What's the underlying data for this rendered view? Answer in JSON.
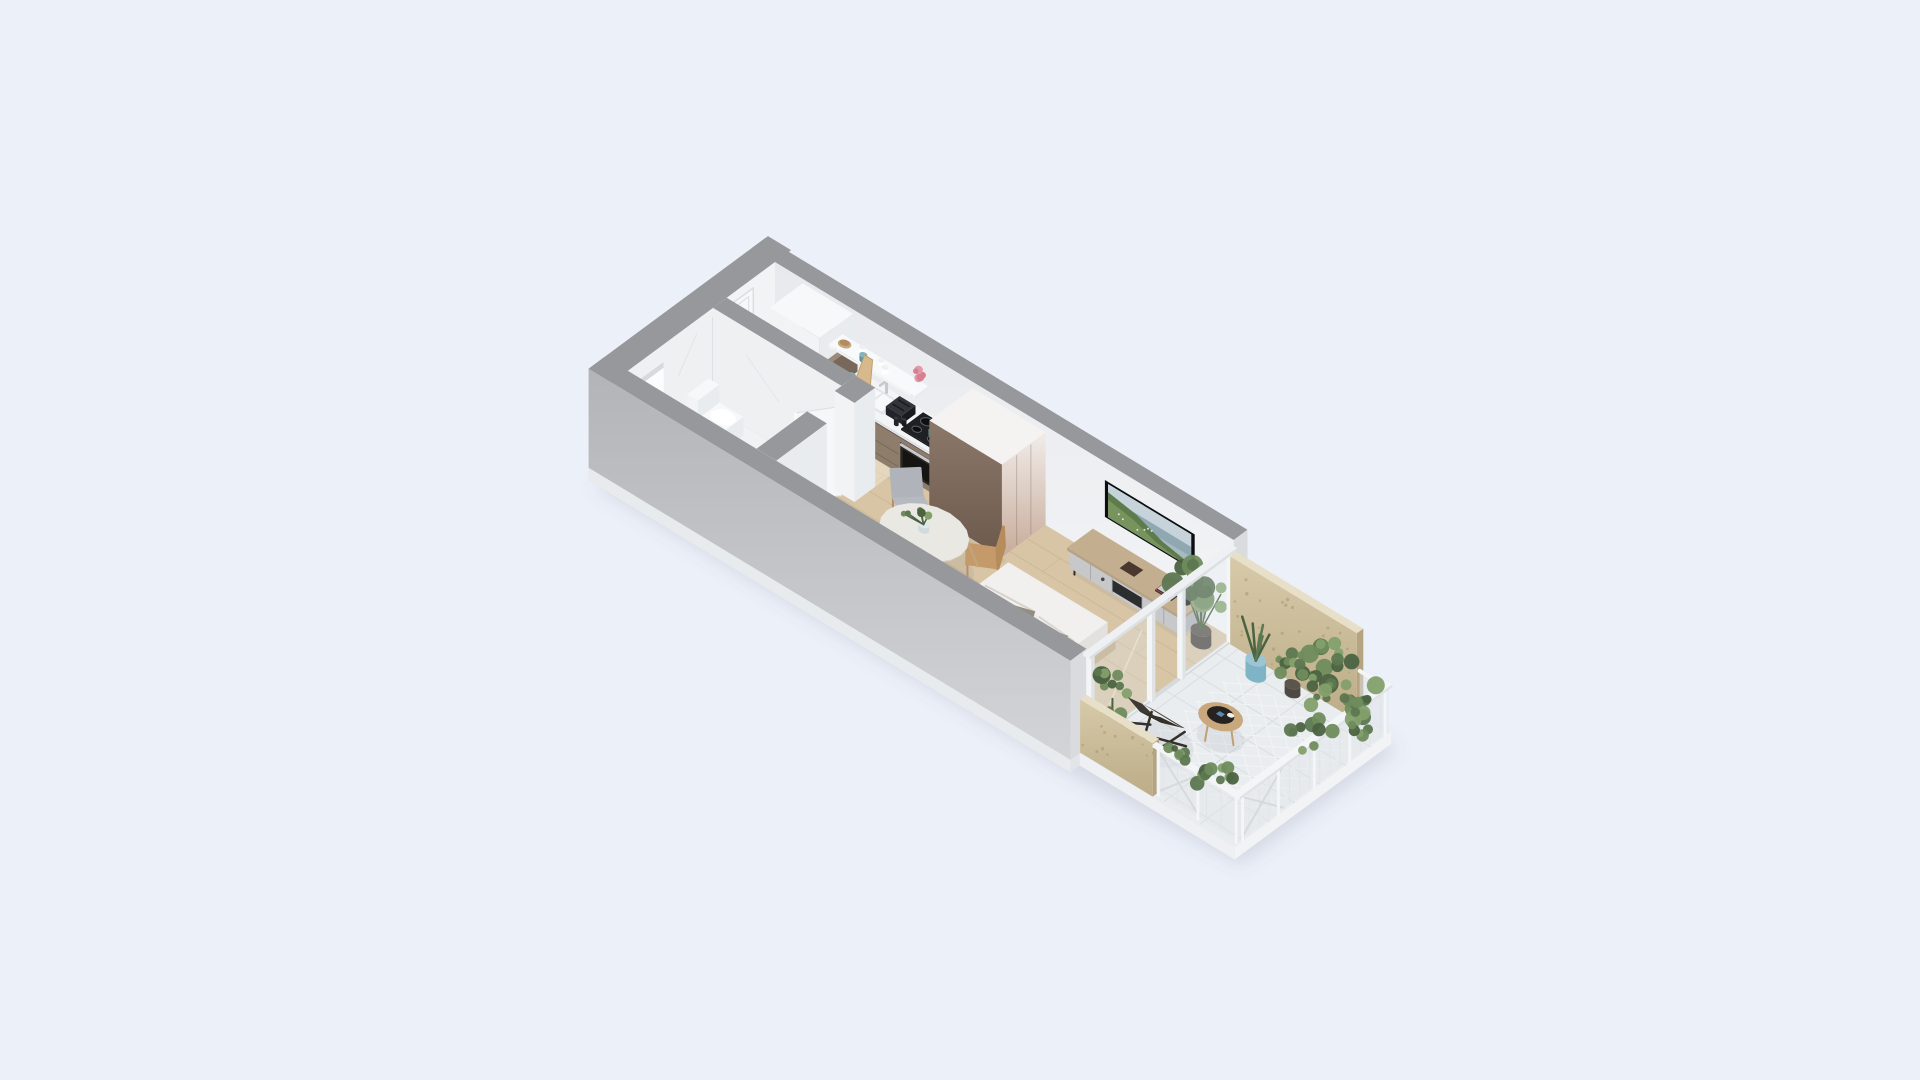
{
  "meta": {
    "description": "Isometric 3D render of a studio apartment floor plan with entry hall, kitchen, marble bathroom, living-bedroom area and a plant-filled balcony, on a pale blue background"
  },
  "rooms": [
    {
      "name": "entry-hall",
      "floor": "wood"
    },
    {
      "name": "bathroom",
      "floor": "marble"
    },
    {
      "name": "kitchen",
      "floor": "wood"
    },
    {
      "name": "living-bedroom",
      "floor": "wood"
    },
    {
      "name": "balcony",
      "floor": "white-tile"
    }
  ],
  "furniture": [
    "entry-door",
    "window-opening",
    "kitchen-tall-cabinet",
    "kitchen-wall-cabinet",
    "kitchen-counter",
    "kitchen-sink",
    "faucet",
    "cooktop",
    "oven",
    "toaster",
    "open-shelf",
    "cutting-board",
    "dishes",
    "flower-vase",
    "bathroom-door",
    "toilet",
    "vanity",
    "shower-tray",
    "wardrobe",
    "dining-table",
    "dining-chairs",
    "table-plant",
    "bench-sofa",
    "side-cube",
    "tv",
    "tv-console",
    "books",
    "speaker",
    "tray",
    "double-bed",
    "mattress",
    "blanket",
    "duvet",
    "pillows",
    "indoor-plant",
    "glass-sliding-door",
    "balcony-plywood-panels",
    "balcony-railing",
    "lounge-chair",
    "balcony-side-table",
    "potted-plants",
    "hanging-plants",
    "blue-pot"
  ],
  "palette": {
    "bg": "#ecf0f9",
    "shadow": "rgba(98,108,130,0.18)",
    "slab1": "#e8ebee",
    "slab2": "#eef0f3",
    "slab3": "#f1f3f5",
    "slabStep": "#e2e5e8",
    "wallTop": "#97989c",
    "extTop": "#b2b4b8",
    "extBot": "#d2d4d7",
    "cap": "#d9dbdf",
    "neTop": "#e7e9ed",
    "neBot": "#f3f4f6",
    "nwFace": "#f2f3f5",
    "marbleFace": "#eef0f2",
    "marbleFloor": "#f0f2f4",
    "vein": "#dde0e4",
    "wood": "#d8c5a6",
    "woodLine": "#c4ae8c",
    "entry": "rgba(240,230,208,0.55)",
    "tile": "#eaedef",
    "tileLine": "#d8dce0",
    "hatch": "#f3f5f6",
    "door": "#f6f7f9",
    "doorFrame": "#dcdee1",
    "handle": "#6f7276",
    "winLight": "#fbfcfe",
    "winShade": "#cfd3d8",
    "cabFace": "#8f7d6c",
    "cabSide": "#77685b",
    "cabDark": "#60554b",
    "colTop": "#9c8a79",
    "counter": "#f3f4f6",
    "counterEdge": "#e2e4e7",
    "shelf": "#f8f9fa",
    "shelfSide": "#e9ebee",
    "stove": "#1f2023",
    "stoveSide": "#121315",
    "burner": "#0e0f11",
    "ring": "#5d6065",
    "ovenFrame": "#2b2824",
    "ovenGlass": "#151413",
    "steel": "#c6c8cb",
    "toastT": "#33353a",
    "toastF": "#23242a",
    "toastS": "#191a1e",
    "board": "#d8b98c",
    "boardEdge": "#c0a070",
    "whiteT": "#f7f8fa",
    "whiteSE": "#e9ecef",
    "whiteSW": "#f1f3f5",
    "wardTop": "#f4f3f2",
    "wardFT": "#f1ece9",
    "wardFB": "#c7ab9a",
    "wardST": "#8b7869",
    "wardSB": "#6c594d",
    "wardSeam": "rgba(110,88,74,0.3)",
    "benchBase": "#e0dbd7",
    "benchSide": "#cfc9c5",
    "cushA": "#dccccc",
    "cushB": "#cfbdbd",
    "backA": "#e3d5d5",
    "backB": "#d6c6c6",
    "pill": "#efeae6",
    "darkT": "#554e47",
    "darkTse": "#413b35",
    "darkTsw": "#4b443e",
    "tableT": "#e9e8e3",
    "tableE": "#d1cfc8",
    "legW": "#c2a47c",
    "seatG": "#b6bac0",
    "seatG2": "#abafb5",
    "backG": "#b0b4ba",
    "woodCh": "#c59a6b",
    "woodChB": "#b78c5b",
    "chLeg": "#b3906a",
    "conSE": "#b0b2b5",
    "conSW": "#c7c8ca",
    "conTT": "#c3af90",
    "conTSE": "#a8957a",
    "conTSW": "#b6a286",
    "recess": "#2c2d2f",
    "conSeam": "#9c9ea2",
    "conHandle": "#46474a",
    "tvFrame": "#0d0e10",
    "tvSky": "#c6d3da",
    "tvSea": "#8fa8b2",
    "tvBase": "#a7bac2",
    "hillA": "#5e7b4c",
    "hillB": "#7a9661",
    "speck": "#e9ece7",
    "stand": "#222327",
    "bookA": "#a8403a",
    "bookB": "#30323a",
    "spk": "#191a1d",
    "spkT": "#2c2d31",
    "tray": "#4a382e",
    "bpT": "#d6c2a0",
    "bpSE": "#c2aa86",
    "bpSW": "#cdb694",
    "matT": "#ebeae8",
    "matSE": "#dbdad7",
    "matSW": "#cfcecb",
    "blan": "#ccd0d4",
    "blanSE": "#b8bcc0",
    "blanLine": "#e3e6e9",
    "duv": "#f1f0ee",
    "duvSE": "#e2e1de",
    "duvSh": "#c7c0b4",
    "pilA": "#e7e2dd",
    "pilB": "#d9d3cd",
    "thrA": "#948a7d",
    "thrB": "#a99e90",
    "fold": "#847b6c",
    "potD": "#4f4943",
    "potDT": "#5b554e",
    "potTan": "#b9a88f",
    "potTanT": "#c9b89e",
    "potBlue": "#7fb3c6",
    "potBlueT": "#9cc5d4",
    "greens": [
      "#5d7751",
      "#6f8c5d",
      "#83a06b",
      "#4b6341"
    ],
    "plyTop": "#e7dfc7",
    "plyCap": "#b4a480",
    "plyL": "#d7caa9",
    "plyD": "#bcac87",
    "speckle": "#a3946f",
    "rail": "#f3f5f7",
    "railEdge": "#dfe2e6",
    "mesh": "rgba(226,231,235,0.45)",
    "brace": "#d4d8db",
    "glass": "rgba(226,237,243,0.28)",
    "glassE": "rgba(255,255,255,0.8)",
    "track": "#eef0f3",
    "trackSE": "#dde0e3",
    "floorTrack": "#d7dadd",
    "loA": "#3e3933",
    "loB": "#332f29",
    "loC": "#48423b",
    "sideT": "#c9a87e",
    "sideTray": "#262220",
    "phone": "#5b89b4",
    "cup": "#eef0f1",
    "teal": "#5f98a3",
    "tealT": "#83b3bc",
    "pink": "#e39aa8",
    "pinkD": "#d87f91",
    "glassCup": "rgba(255,255,255,0.78)",
    "glassStroke": "#d8dbde",
    "bowl": "#c8a87e",
    "bowlD": "#b08c5e",
    "greenCup": "#4e7d72",
    "greenCupD": "#5f8e83",
    "ao": "rgba(90,100,120,0.09)"
  }
}
